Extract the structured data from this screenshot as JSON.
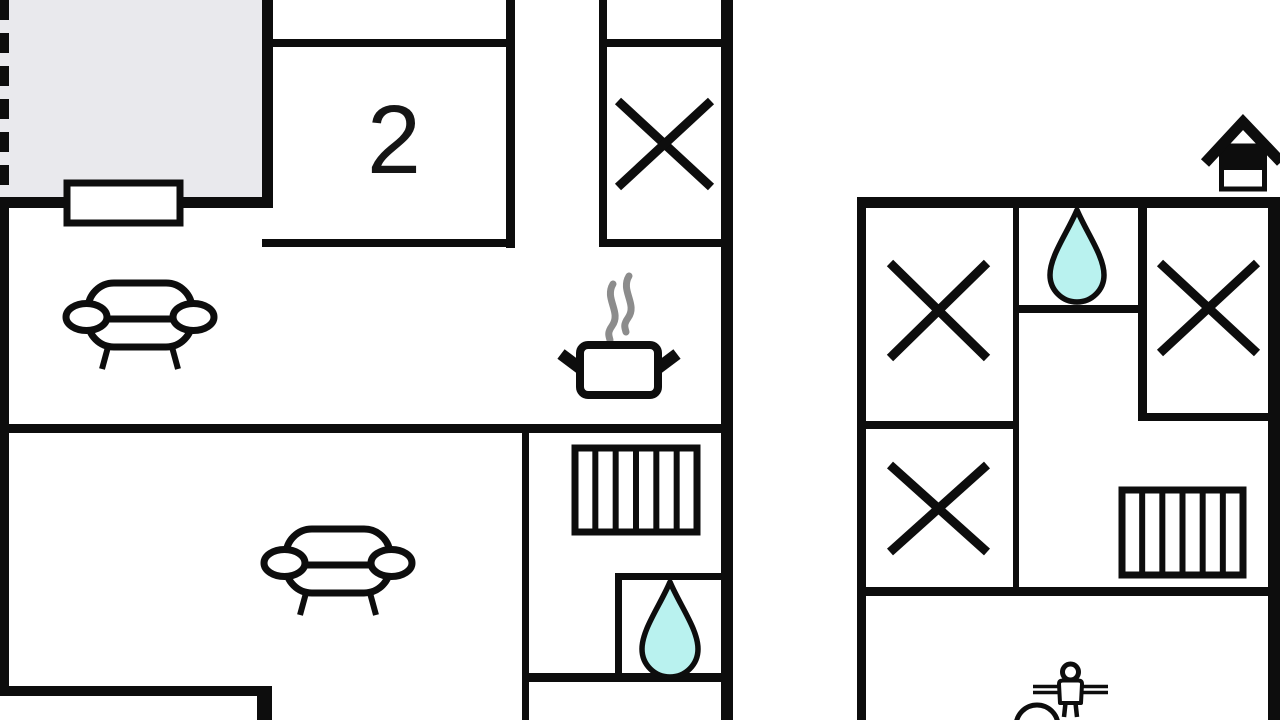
{
  "page": {
    "kind": "floor-plan-drawing"
  },
  "colors": {
    "wall": "#0d0d0d",
    "paper": "#ffffff",
    "terrace_fill": "#e9e9ed",
    "water": "#b9f2ef",
    "steam": "#8c8c8c",
    "label": "#151515"
  },
  "floorplan": {
    "room_label": {
      "text": "2",
      "x": 394,
      "y": 173,
      "font_size": 97
    },
    "terrace": {
      "x": 0,
      "y": 0,
      "w": 273,
      "h": 204
    },
    "dashed_edge": {
      "x": 4.5,
      "y1": 0,
      "y2": 197,
      "stroke_width": 9,
      "dash": "20 13"
    },
    "window": {
      "x": 67,
      "y": 183,
      "w": 113,
      "h": 40,
      "stroke_width": 7
    },
    "walls": [
      {
        "name": "terrace-bottom-wall",
        "x": 0,
        "y": 197,
        "w": 273,
        "h": 11
      },
      {
        "name": "terrace-right-wall",
        "x": 262,
        "y": 0,
        "w": 11,
        "h": 208
      },
      {
        "name": "left-outer-wall",
        "x": 0,
        "y": 197,
        "w": 9,
        "h": 499
      },
      {
        "name": "room2-top-wall",
        "x": 273,
        "y": 39,
        "w": 242,
        "h": 8
      },
      {
        "name": "room2-right-wall",
        "x": 506,
        "y": 0,
        "w": 9,
        "h": 248
      },
      {
        "name": "room2-bottom-wall",
        "x": 262,
        "y": 239,
        "w": 253,
        "h": 8
      },
      {
        "name": "bedroom1-left-wall",
        "x": 599,
        "y": 0,
        "w": 8,
        "h": 247
      },
      {
        "name": "bedroom1-top-wall",
        "x": 599,
        "y": 39,
        "w": 122,
        "h": 8
      },
      {
        "name": "bedroom1-bottom-wall",
        "x": 599,
        "y": 239,
        "w": 122,
        "h": 8
      },
      {
        "name": "left-building-right-wall",
        "x": 721,
        "y": 0,
        "w": 12,
        "h": 720
      },
      {
        "name": "left-building-mid-wall",
        "x": 0,
        "y": 424,
        "w": 733,
        "h": 9
      },
      {
        "name": "hall-left-wall",
        "x": 522,
        "y": 424,
        "w": 7,
        "h": 296
      },
      {
        "name": "bathroom-left-wall",
        "x": 615,
        "y": 573,
        "w": 7,
        "h": 106
      },
      {
        "name": "bathroom-top-wall",
        "x": 615,
        "y": 573,
        "w": 106,
        "h": 7
      },
      {
        "name": "bathroom-bottom-wall",
        "x": 524,
        "y": 673,
        "w": 197,
        "h": 9
      },
      {
        "name": "living-bottom-wall",
        "x": 0,
        "y": 686,
        "w": 272,
        "h": 10
      },
      {
        "name": "living-bottom-return-wall",
        "x": 257,
        "y": 686,
        "w": 15,
        "h": 34
      },
      {
        "name": "right-building-top-wall",
        "x": 857,
        "y": 197,
        "w": 423,
        "h": 11
      },
      {
        "name": "right-building-left-wall",
        "x": 857,
        "y": 197,
        "w": 9,
        "h": 523
      },
      {
        "name": "right-building-right-wall",
        "x": 1268,
        "y": 197,
        "w": 12,
        "h": 523
      },
      {
        "name": "right-building-inner-vertical-wall",
        "x": 1013,
        "y": 208,
        "w": 6,
        "h": 384
      },
      {
        "name": "droproom-right-wall",
        "x": 1138,
        "y": 208,
        "w": 9,
        "h": 213
      },
      {
        "name": "droproom-bottom-wall",
        "x": 1019,
        "y": 305,
        "w": 128,
        "h": 8
      },
      {
        "name": "bedroom2-bottom-wall",
        "x": 866,
        "y": 421,
        "w": 151,
        "h": 8
      },
      {
        "name": "bedroom3-bottom-wall",
        "x": 1138,
        "y": 413,
        "w": 142,
        "h": 8
      },
      {
        "name": "right-building-mid-wall",
        "x": 857,
        "y": 587,
        "w": 423,
        "h": 9
      }
    ],
    "bed_crosses": [
      {
        "name": "bed-cross-symbol-1",
        "x1": 618,
        "y1": 101,
        "x2": 711,
        "y2": 187
      },
      {
        "name": "bed-cross-symbol-2",
        "x1": 890,
        "y1": 263,
        "x2": 987,
        "y2": 358
      },
      {
        "name": "bed-cross-symbol-3",
        "x1": 1160,
        "y1": 263,
        "x2": 1257,
        "y2": 353
      },
      {
        "name": "bed-cross-symbol-4",
        "x1": 890,
        "y1": 465,
        "x2": 987,
        "y2": 552
      }
    ],
    "bed_cross_stroke": 9,
    "stairs": [
      {
        "name": "stairs-symbol-left",
        "x": 575,
        "y": 448,
        "w": 122,
        "h": 84,
        "steps": 6
      },
      {
        "name": "stairs-symbol-right",
        "x": 1122,
        "y": 490,
        "w": 121,
        "h": 85,
        "steps": 6
      }
    ],
    "water_drops": [
      {
        "name": "water-drop-icon-bathroom",
        "cx": 670,
        "top": 582,
        "w": 56,
        "h": 95
      },
      {
        "name": "water-drop-icon-droproom",
        "cx": 1077,
        "top": 210,
        "w": 54,
        "h": 92
      }
    ],
    "sofas": [
      {
        "name": "sofa-symbol-upper",
        "x": 66,
        "y": 283
      },
      {
        "name": "sofa-symbol-lower",
        "x": 264,
        "y": 529
      }
    ],
    "sofa_shape": {
      "w": 148,
      "h": 86,
      "body": {
        "x": 22,
        "y": 0,
        "w": 104,
        "h": 64,
        "r": 26
      },
      "seat_y": 36,
      "arm": {
        "rx": 20.5,
        "ry": 13.5,
        "cy": 34,
        "lcx": 20.5,
        "rcx": 127.5
      },
      "legs": [
        [
          42,
          64,
          36,
          86
        ],
        [
          106,
          64,
          112,
          86
        ]
      ],
      "stroke": 7,
      "leg_stroke": 6
    },
    "stove": {
      "pot": {
        "x": 580,
        "y": 345,
        "w": 78,
        "h": 50,
        "r": 8,
        "stroke": 8
      },
      "handles": [
        [
          561,
          354,
          581,
          369
        ],
        [
          677,
          354,
          657,
          369
        ]
      ],
      "handle_stroke": 12,
      "steam_starts": [
        {
          "x": 613,
          "y": 284
        },
        {
          "x": 629,
          "y": 276
        }
      ],
      "steam_path": "c-9,15 9,28 -1,42 c-5,7 -3,10 -2,14",
      "steam_stroke": 7
    },
    "shower_person": {
      "head": {
        "cx": 1070.5,
        "cy": 672,
        "r": 8,
        "stroke": 5
      },
      "arm_lines": [
        [
          1033,
          686.5,
          1108,
          686.5
        ],
        [
          1033,
          692.5,
          1108,
          692.5
        ]
      ],
      "arm_stroke": 3.5,
      "torso_path": "M1059,684 Q1059,680.5 1063,680.5 L1078,680.5 Q1082,680.5 1082,684 L1081,703 L1060,703 Z",
      "torso_stroke": 4,
      "legs": [
        [
          1065.5,
          703,
          1064,
          717
        ],
        [
          1075.5,
          703,
          1077,
          717
        ]
      ],
      "leg_stroke": 4.5,
      "basin": {
        "cx": 1037,
        "cy": 726,
        "r": 21,
        "stroke": 5
      }
    },
    "house_icon": {
      "roof": [
        [
          1205,
          163
        ],
        [
          1243,
          122
        ],
        [
          1281,
          162
        ]
      ],
      "roof_stroke": 11,
      "body": {
        "x": 1221.5,
        "y": 146,
        "w": 43,
        "h": 43,
        "stroke": 5
      },
      "band": {
        "x": 1221.5,
        "y": 146,
        "w": 43,
        "h": 24
      }
    }
  }
}
